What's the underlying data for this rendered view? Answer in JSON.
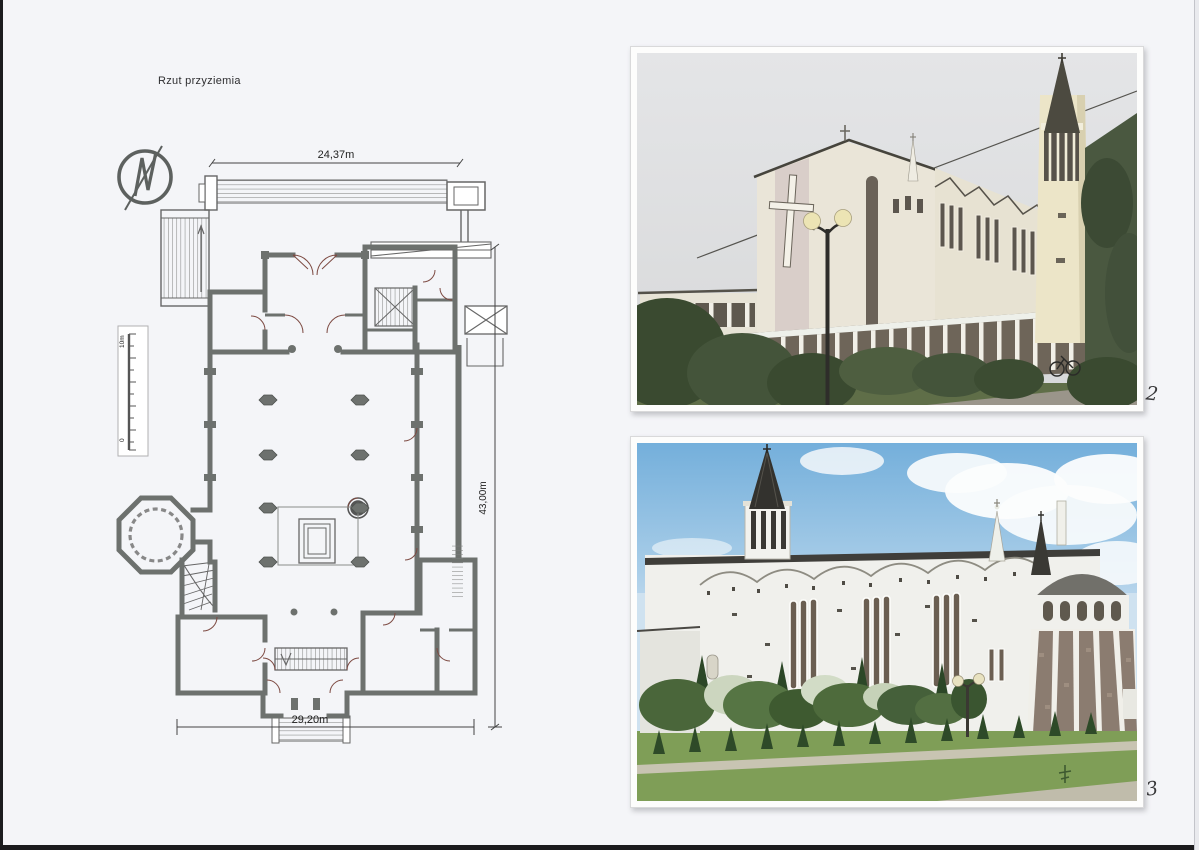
{
  "page": {
    "plan_title": "Rzut przyziemia"
  },
  "plan": {
    "dimensions": {
      "top": "24,37m",
      "right": "43,00m",
      "bottom": "29,20m"
    },
    "scale_bar": {
      "max": "10m",
      "min": "0"
    },
    "icons": {
      "compass": "north-arrow"
    },
    "colors": {
      "wall": "#6d716e",
      "thin_line": "#666666",
      "door_swing": "#7d4a42"
    }
  },
  "photos": {
    "top": {
      "label": "2",
      "colors": {
        "sky": "#e0e2e4",
        "facade": "#eae5d8",
        "spire": "#4c4a40",
        "stone_base": "#6e6559"
      }
    },
    "bottom": {
      "label": "3",
      "colors": {
        "sky": "#79b2dc",
        "wall": "#f0f0ec",
        "grass": "#7f9e57",
        "apse_stone": "#8b7c70"
      }
    }
  }
}
